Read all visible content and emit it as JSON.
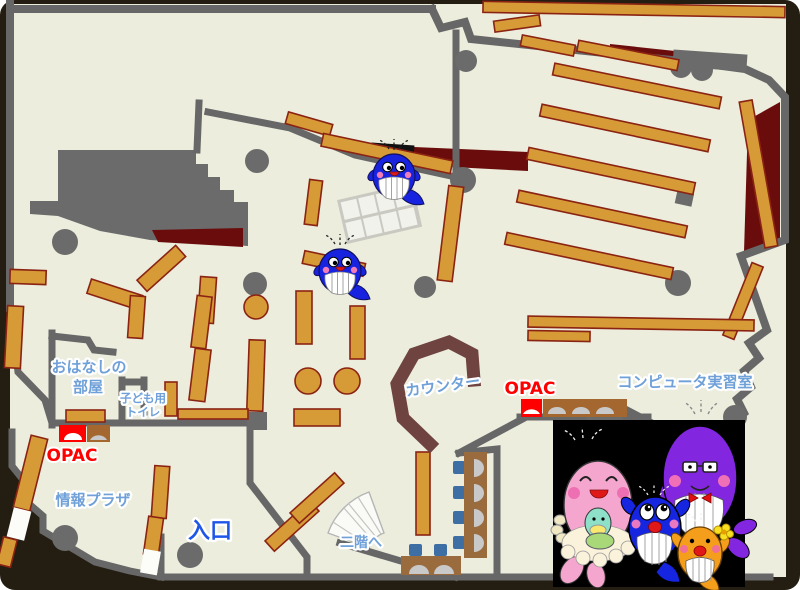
{
  "map": {
    "labels": {
      "storytelling_room_line1": "おはなしの",
      "storytelling_room_line2": "部屋",
      "kids_toilet_line1": "子ども用",
      "kids_toilet_line2": "トイレ",
      "opac_left": "OPAC",
      "opac_right": "OPAC",
      "info_plaza": "情報プラザ",
      "entrance": "入口",
      "counter": "カウンター",
      "computer_room": "コンピュータ実習室",
      "to_second_floor": "二階へ"
    },
    "colors": {
      "outside": "#241d12",
      "floor": "#ECEDDD",
      "wall": "#676767",
      "pillar": "#6B6B6B",
      "shelf": "#D69A36",
      "shelf-border": "#8B2313",
      "counter": "#6E4340",
      "dark-red": "#6B0C0C",
      "label-blue": "#6FA0D8",
      "entrance-blue": "#1E56E8",
      "opac-red": "#FF0000",
      "opac-brown": "#A4672F",
      "desk-brown": "#9A6B3D",
      "chair-blue": "#3D6FA5",
      "door-white": "#FCFCF8",
      "box-black": "#000000",
      "whale-blue": "#1823E0",
      "mascot-pink": "#F5A6CE",
      "mascot-purple": "#8226DF",
      "mascot-orange": "#F59E1C",
      "mascot-mint": "#8FE0C8"
    },
    "mascots": {
      "on_map": "small-blue-whale-icon",
      "family": [
        "pink-whale-with-baby",
        "blue-whale",
        "purple-whale-with-glasses",
        "orange-whale-with-flower"
      ]
    }
  }
}
